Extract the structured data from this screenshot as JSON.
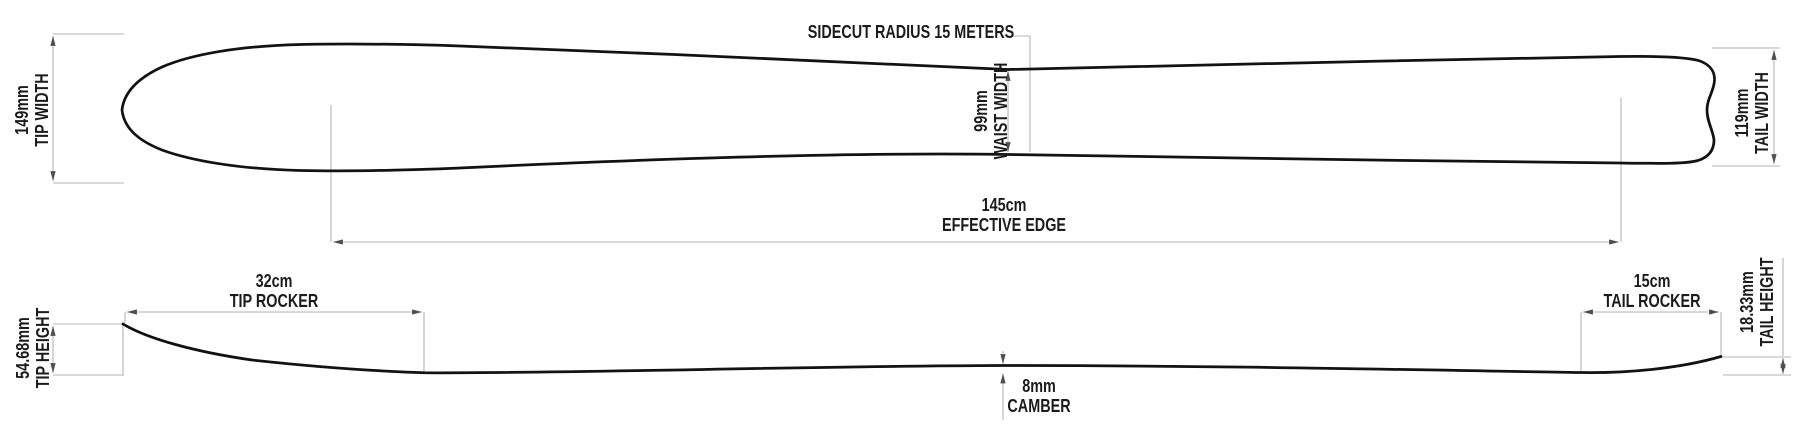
{
  "top_view": {
    "tip_width": {
      "value": "149mm",
      "label": "TIP WIDTH"
    },
    "sidecut_radius": {
      "label": "SIDECUT RADIUS 15 METERS"
    },
    "waist_width": {
      "value": "99mm",
      "label": "WAIST WIDTH"
    },
    "tail_width": {
      "value": "119mm",
      "label": "TAIL WIDTH"
    },
    "effective_edge": {
      "value": "145cm",
      "label": "EFFECTIVE EDGE"
    }
  },
  "profile_view": {
    "tip_height": {
      "value": "54.68mm",
      "label": "TIP HEIGHT"
    },
    "tip_rocker": {
      "value": "32cm",
      "label": "TIP ROCKER"
    },
    "camber": {
      "value": "8mm",
      "label": "CAMBER"
    },
    "tail_rocker": {
      "value": "15cm",
      "label": "TAIL ROCKER"
    },
    "tail_height": {
      "value": "18.33mm",
      "label": "TAIL HEIGHT"
    }
  },
  "colors": {
    "ski_outline": "#121212",
    "dimension_lines": "#b4b4b4",
    "arrowheads": "#4f4f4f",
    "text": "#1b1b1b",
    "background": "#ffffff"
  }
}
